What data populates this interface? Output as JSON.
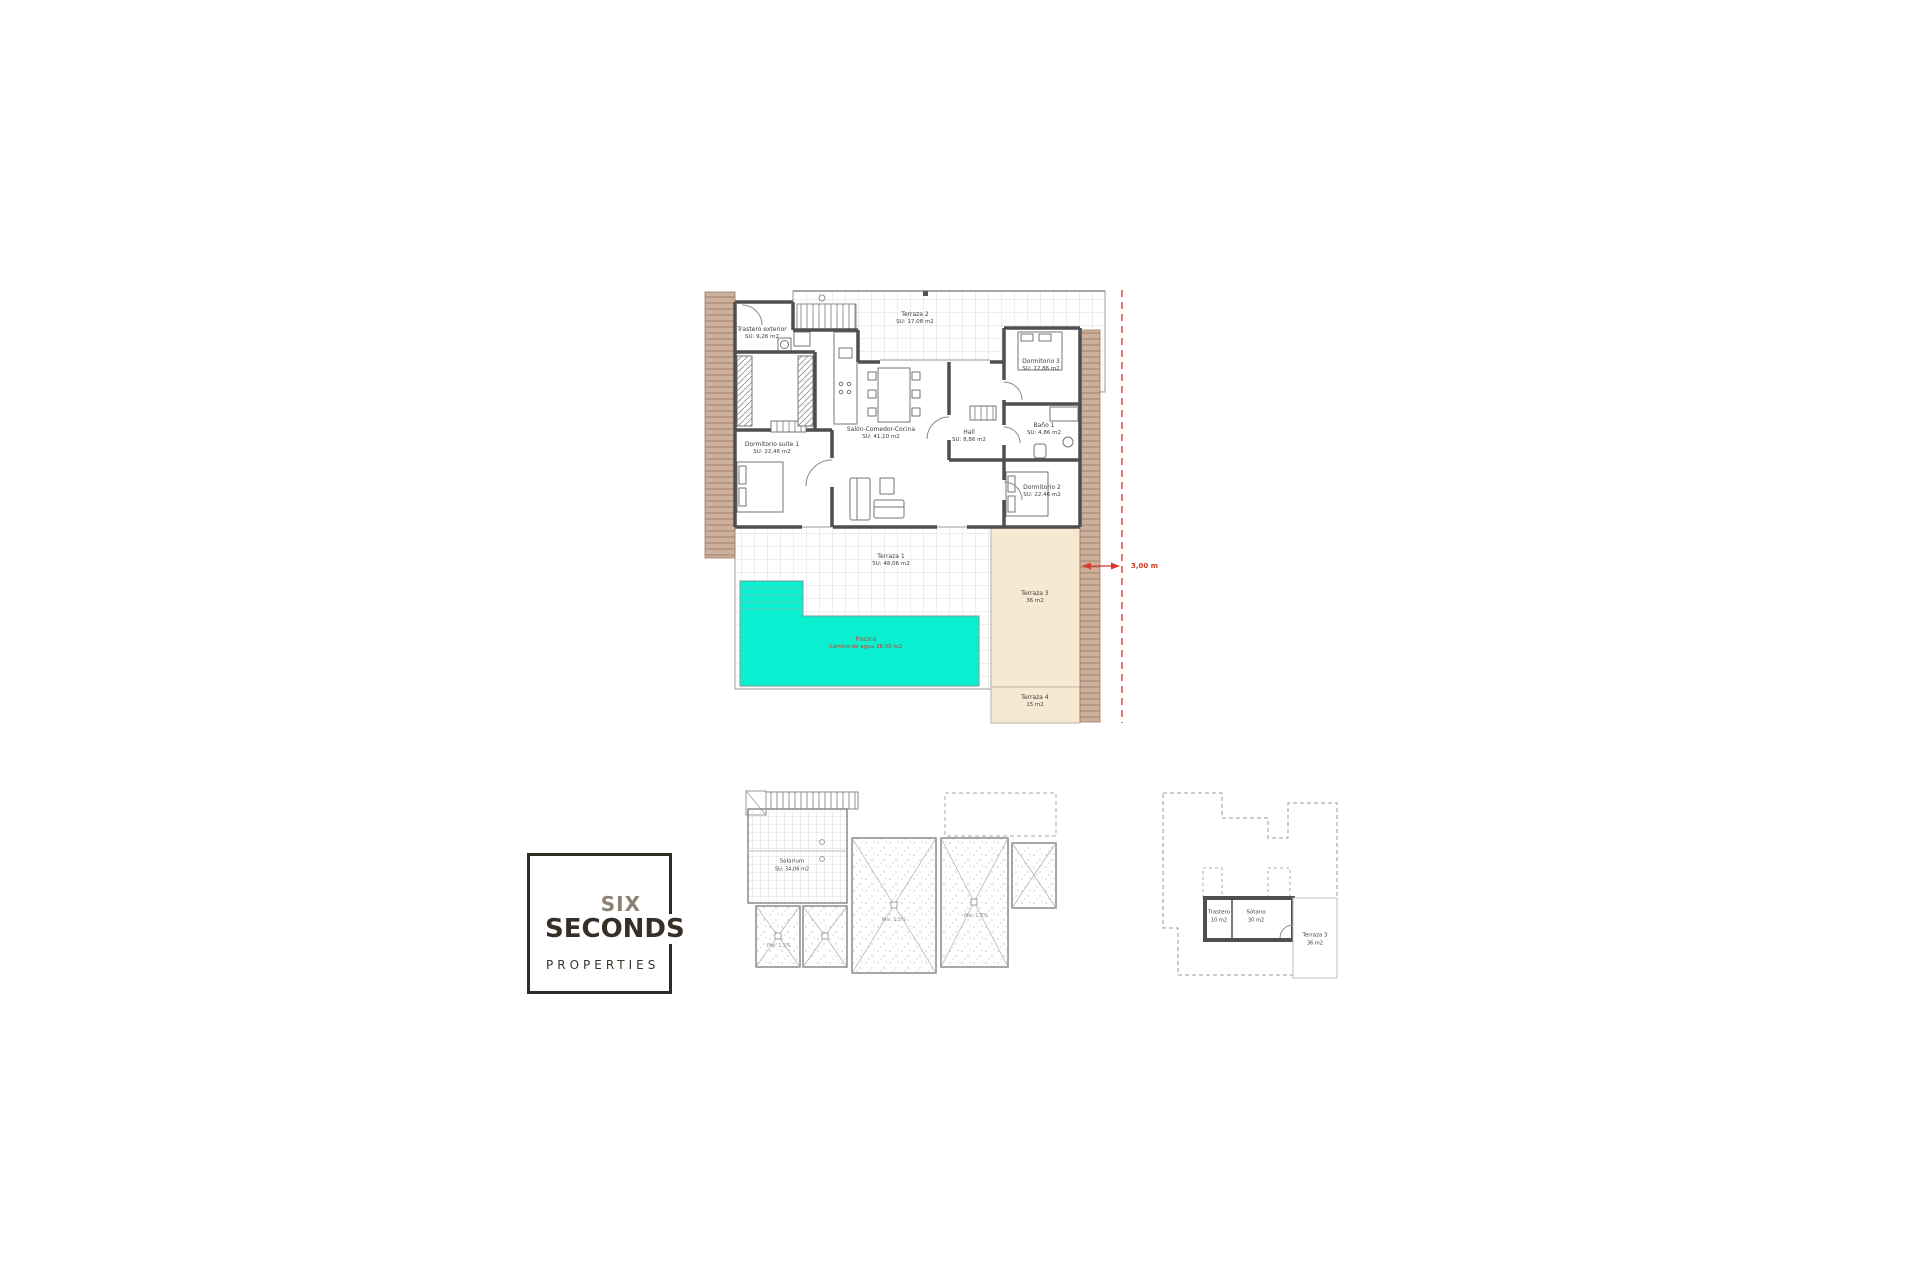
{
  "floor_plan": {
    "rooms": [
      {
        "name": "Trastero exterior",
        "area": "SU: 9,26 m2"
      },
      {
        "name": "Terraza 2",
        "area": "SU: 17,08 m2"
      },
      {
        "name": "Dormitorio 3",
        "area": "SU: 12,86 m2"
      },
      {
        "name": "Baño 1",
        "area": "SU: 4,86 m2"
      },
      {
        "name": "Dormitorio 2",
        "area": "SU: 22,46 m2"
      },
      {
        "name": "Dormitorio suite 1",
        "area": "SU: 22,46 m2"
      },
      {
        "name": "Salón-Comedor-Cocina",
        "area": "SU: 41,10 m2"
      },
      {
        "name": "Hall",
        "area": "SU: 8,86 m2"
      },
      {
        "name": "Terraza 1",
        "area": "SU: 48,06 m2"
      },
      {
        "name": "Terraza 3",
        "area": "36 m2"
      },
      {
        "name": "Terraza 4",
        "area": "15 m2"
      }
    ],
    "pool": {
      "name": "Piscina",
      "detail": "Lámina de agua 38,00 m2"
    },
    "dimension_label": "3,00 m",
    "colors": {
      "pool": "#0aefd0",
      "terrace_fill": "#f6e9d2",
      "hatch_fill": "#cdb09c",
      "wall": "#4f4f4f",
      "annotation_red": "#cf3a2a"
    }
  },
  "roof_plan": {
    "solarium": {
      "name": "Solarium",
      "area": "SU: 34,06 m2"
    },
    "slope_note": "Pte. 1,5%"
  },
  "basement_plan": {
    "rooms": [
      {
        "name": "Trastero",
        "area": "10 m2"
      },
      {
        "name": "Sótano",
        "area": "30 m2"
      },
      {
        "name": "Terraza 3",
        "area": "36 m2"
      }
    ]
  },
  "logo": {
    "line1": "SIX",
    "line2": "SECONDS",
    "line3": "PROPERTIES"
  }
}
